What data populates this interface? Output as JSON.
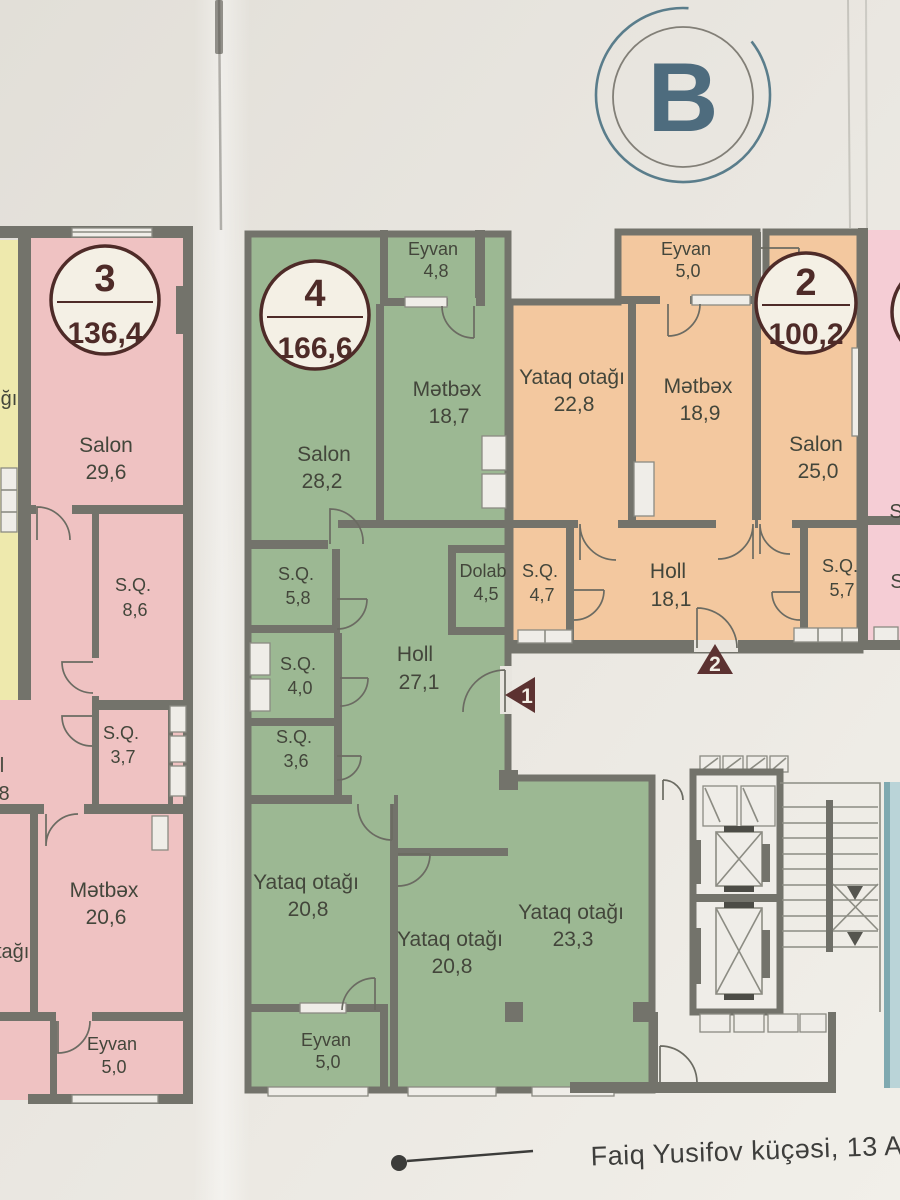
{
  "meta": {
    "block_label": "B",
    "street_label": "Faiq Yusifov küçəsi, 13 A"
  },
  "apartments": [
    {
      "id": "apt-3",
      "number": "3",
      "total_area": "136,4",
      "rooms": [
        {
          "name": "Salon",
          "area": "29,6"
        },
        {
          "name": "S.Q.",
          "area": "8,6"
        },
        {
          "name": "S.Q.",
          "area": "3,7"
        },
        {
          "name": "Mətbəx",
          "area": "20,6"
        },
        {
          "name": "Eyvan",
          "area": "5,0"
        }
      ]
    },
    {
      "id": "apt-4",
      "number": "4",
      "total_area": "166,6",
      "rooms": [
        {
          "name": "Eyvan",
          "area": "4,8"
        },
        {
          "name": "Mətbəx",
          "area": "18,7"
        },
        {
          "name": "Salon",
          "area": "28,2"
        },
        {
          "name": "S.Q.",
          "area": "5,8"
        },
        {
          "name": "Dolab",
          "area": "4,5"
        },
        {
          "name": "S.Q.",
          "area": "4,0"
        },
        {
          "name": "Holl",
          "area": "27,1"
        },
        {
          "name": "S.Q.",
          "area": "3,6"
        },
        {
          "name": "Yataq otağı",
          "area": "20,8"
        },
        {
          "name": "Yataq otağı",
          "area": "20,8"
        },
        {
          "name": "Yataq otağı",
          "area": "23,3"
        },
        {
          "name": "Eyvan",
          "area": "5,0"
        }
      ]
    },
    {
      "id": "apt-2",
      "number": "2",
      "total_area": "100,2",
      "rooms": [
        {
          "name": "Eyvan",
          "area": "5,0"
        },
        {
          "name": "Yataq otağı",
          "area": "22,8"
        },
        {
          "name": "Mətbəx",
          "area": "18,9"
        },
        {
          "name": "Salon",
          "area": "25,0"
        },
        {
          "name": "S.Q.",
          "area": "4,7"
        },
        {
          "name": "Holl",
          "area": "18,1"
        },
        {
          "name": "S.Q.",
          "area": "5,7"
        }
      ]
    }
  ],
  "markers": [
    {
      "label": "1"
    },
    {
      "label": "2"
    }
  ],
  "fragments": {
    "left": [
      "ğı",
      "l",
      "8",
      "tağı"
    ],
    "right": [
      "S",
      "S"
    ]
  },
  "colors": {
    "paper": "#e8e5df",
    "wall": "#73736b",
    "ink": "#43463b",
    "apt3_fill": "#efc2c2",
    "apt4_fill": "#9cb893",
    "apt2_fill": "#f3c89f",
    "yellow_fill": "#eee9ad",
    "rose_fill": "#f5cdd5",
    "blue_fill": "#bad4d8",
    "badge_bg": "#f4f0e5",
    "badge_ink": "#4e2b28",
    "marker": "#5c3231",
    "emblem": "#4e6c7e",
    "street_ink": "#3e3e3c",
    "white": "#efede8"
  }
}
